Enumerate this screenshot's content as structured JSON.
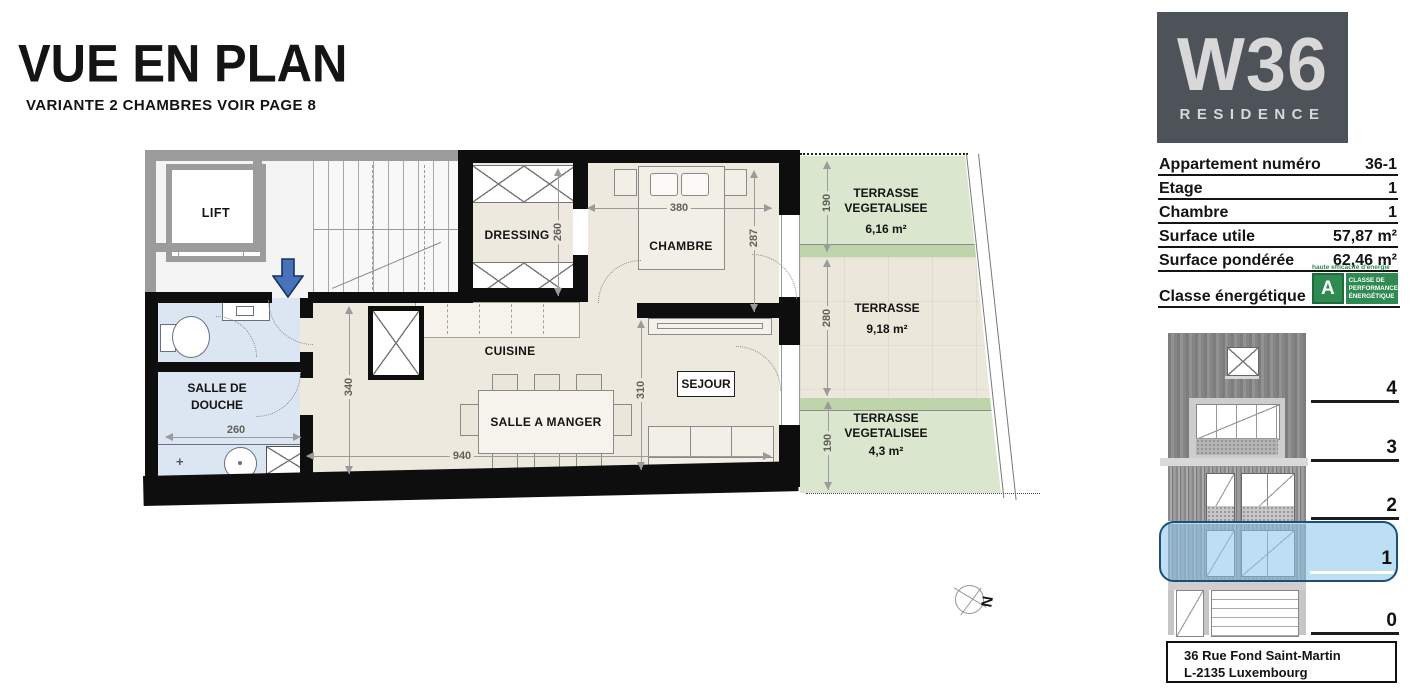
{
  "page": {
    "title": "VUE EN PLAN",
    "subtitle": "VARIANTE 2 CHAMBRES VOIR PAGE 8"
  },
  "logo": {
    "brand": "W36",
    "sub": "RESIDENCE"
  },
  "apartment": {
    "rows": [
      {
        "label": "Appartement numéro",
        "value": "36-1"
      },
      {
        "label": "Etage",
        "value": "1"
      },
      {
        "label": "Chambre",
        "value": "1"
      },
      {
        "label": "Surface utile",
        "value": "57,87 m²"
      },
      {
        "label": "Surface pondérée",
        "value": "62,46 m²"
      }
    ],
    "energy": {
      "label": "Classe énergétique",
      "tagline": "haute efficacité d'énergie",
      "class": "A",
      "badge_lines": [
        "CLASSE DE",
        "PERFORMANCE",
        "ÉNERGÉTIQUE"
      ]
    }
  },
  "plan": {
    "rooms": {
      "lift": "LIFT",
      "dressing": "DRESSING",
      "chambre": "CHAMBRE",
      "cuisine": "CUISINE",
      "sejour": "SEJOUR",
      "douche_l1": "SALLE DE",
      "douche_l2": "DOUCHE",
      "manger": "SALLE A MANGER"
    },
    "terraces": [
      {
        "l1": "TERRASSE",
        "l2": "VEGETALISEE",
        "area": "6,16 m²"
      },
      {
        "l1": "TERRASSE",
        "area": "9,18 m²"
      },
      {
        "l1": "TERRASSE",
        "l2": "VEGETALISEE",
        "area": "4,3 m²"
      }
    ],
    "dims": {
      "dressing_h": "260",
      "chambre_w": "380",
      "chambre_h": "287",
      "hall_h": "340",
      "main_w": "940",
      "sejour_h": "310",
      "douche_w": "260",
      "t1": "190",
      "t2": "280",
      "t3": "190"
    },
    "north": "N",
    "stair_mark": "T"
  },
  "elevation": {
    "floors": [
      "4",
      "3",
      "2",
      "1",
      "0"
    ]
  },
  "address": {
    "line1": "36 Rue Fond Saint-Martin",
    "line2": "L-2135 Luxembourg"
  },
  "colors": {
    "wall": "#0e0e0e",
    "floor_beige": "#ede9df",
    "bath_blue": "#dce6f2",
    "terrace_green": "#dae6cd",
    "terrace_band": "#bed4ab",
    "highlight_blue": "#8dc7eb",
    "entrance_arrow": "#4a72ba",
    "energy_green": "#2e8a50"
  }
}
